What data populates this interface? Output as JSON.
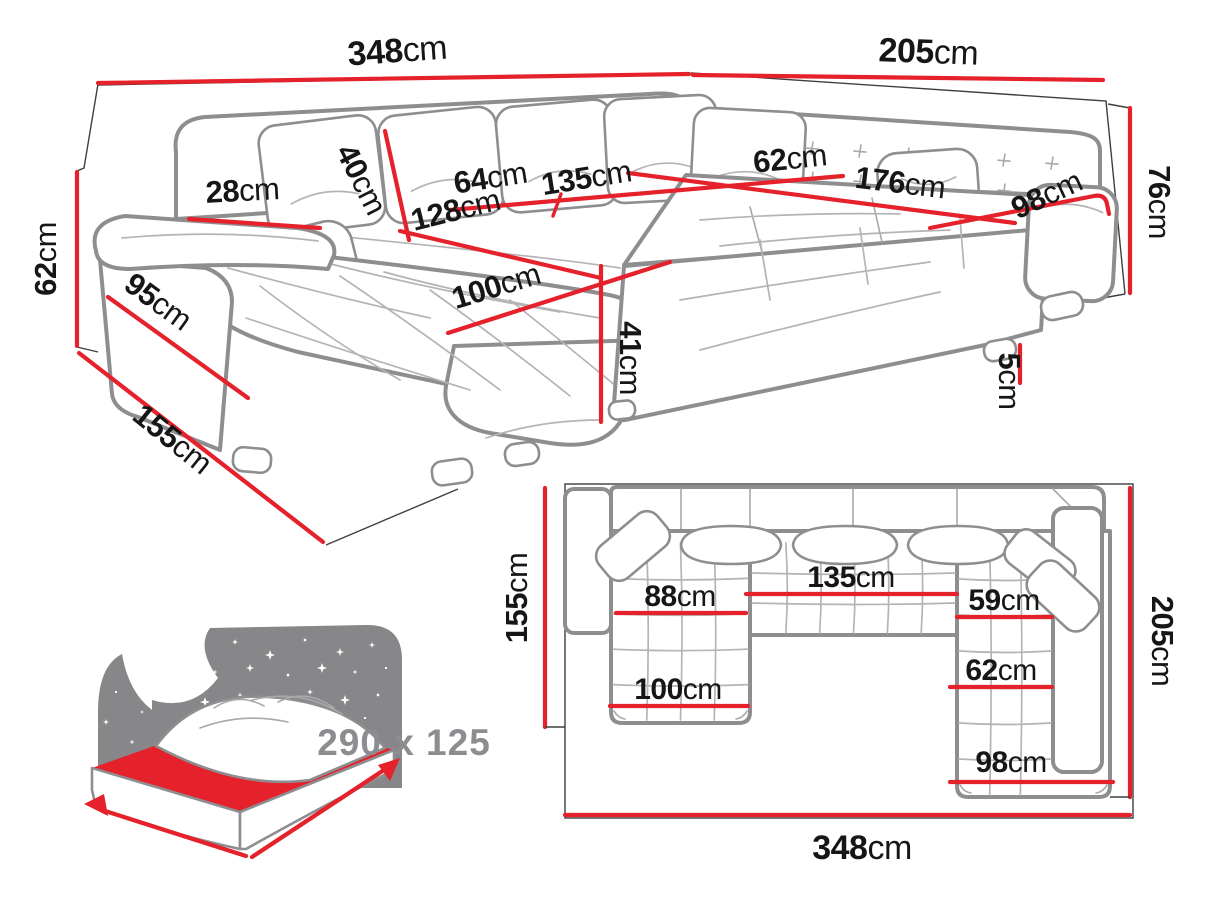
{
  "diagram_title": "Corner sofa dimensions diagram",
  "colors": {
    "dimension_red": "#e5212b",
    "outline_gray": "#8e8e91",
    "detail_gray": "#b4b4b7",
    "wall_black": "#3f3f3f",
    "text_black": "#161616",
    "muted_gray": "#8d8d91"
  },
  "perspective_view": {
    "description": "3D perspective view of U-shaped corner sofa with dimension lines",
    "dims": {
      "width_left": {
        "value": "348",
        "unit": "cm"
      },
      "width_right": {
        "value": "205",
        "unit": "cm"
      },
      "back_height": {
        "value": "76",
        "unit": "cm"
      },
      "arm_height": {
        "value": "62",
        "unit": "cm"
      },
      "depth_side": {
        "value": "155",
        "unit": "cm"
      },
      "arm_front": {
        "value": "95",
        "unit": "cm"
      },
      "arm_top_width": {
        "value": "28",
        "unit": "cm"
      },
      "back_cushion": {
        "value": "40",
        "unit": "cm"
      },
      "seat_back_depth": {
        "value": "64",
        "unit": "cm"
      },
      "middle_seat_width": {
        "value": "135",
        "unit": "cm"
      },
      "chaise_length": {
        "value": "128",
        "unit": "cm"
      },
      "chaise_width": {
        "value": "100",
        "unit": "cm"
      },
      "seat_height": {
        "value": "41",
        "unit": "cm"
      },
      "right_seat_depth": {
        "value": "62",
        "unit": "cm"
      },
      "right_seat_length": {
        "value": "176",
        "unit": "cm"
      },
      "right_back_width": {
        "value": "98",
        "unit": "cm"
      },
      "leg_height": {
        "value": "5",
        "unit": "cm"
      }
    }
  },
  "plan_view": {
    "description": "Top-down plan view of U-shaped corner sofa",
    "dims": {
      "depth_left": {
        "value": "155",
        "unit": "cm"
      },
      "depth_right": {
        "value": "205",
        "unit": "cm"
      },
      "total_width": {
        "value": "348",
        "unit": "cm"
      },
      "left_seat_width": {
        "value": "88",
        "unit": "cm"
      },
      "middle_seat_width": {
        "value": "135",
        "unit": "cm"
      },
      "right_seat_width": {
        "value": "59",
        "unit": "cm"
      },
      "chaise_width": {
        "value": "100",
        "unit": "cm"
      },
      "right_seat_depth": {
        "value": "62",
        "unit": "cm"
      },
      "right_bottom_width": {
        "value": "98",
        "unit": "cm"
      }
    }
  },
  "sleeping_area": {
    "icon": "bed-moon-stars-icon",
    "label": "290 x 125"
  }
}
